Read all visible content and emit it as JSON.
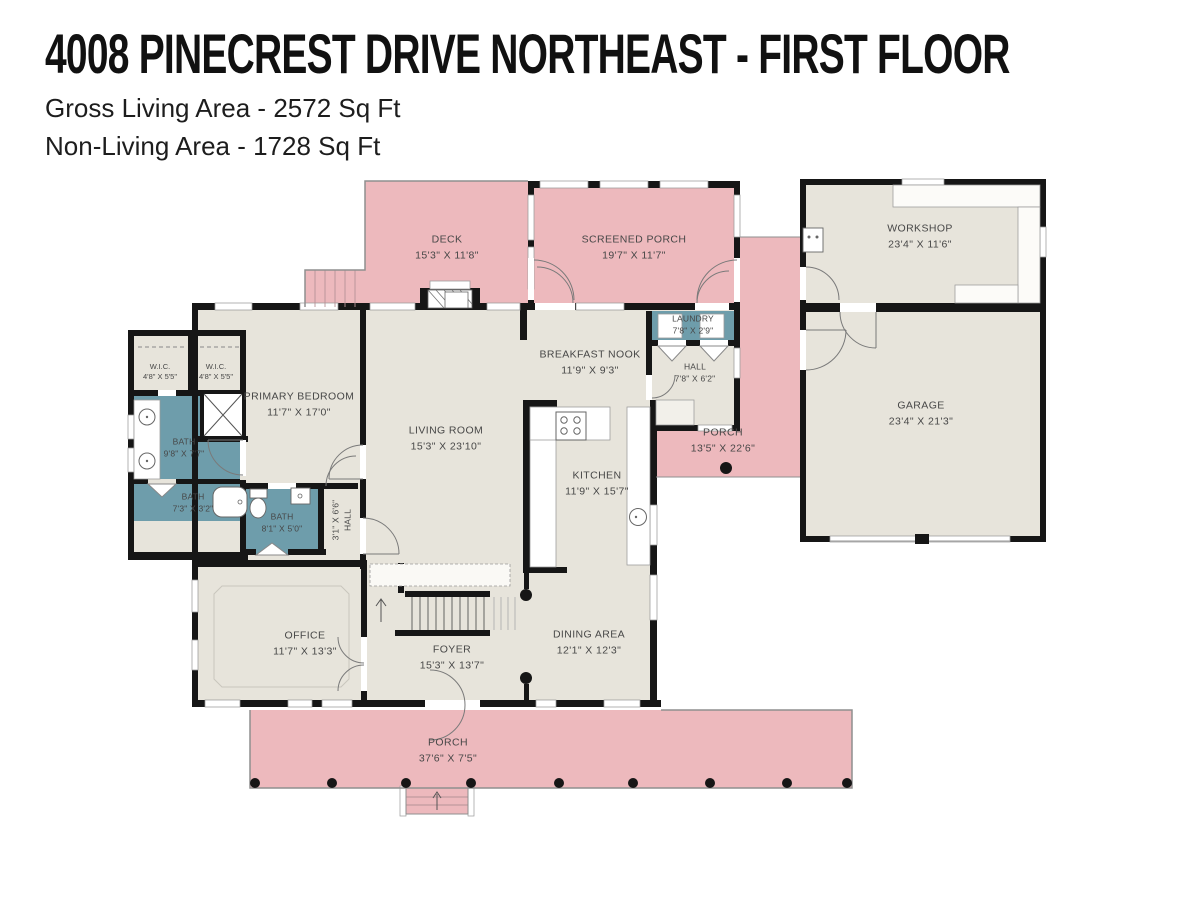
{
  "header": {
    "title": "4008 PINECREST DRIVE NORTHEAST - FIRST FLOOR",
    "gross_living": "Gross Living Area - 2572 Sq Ft",
    "non_living": "Non-Living Area - 1728 Sq Ft"
  },
  "palette": {
    "porch_pink": "#EDB9BD",
    "floor_beige": "#E7E4DB",
    "wet_room_teal": "#6E9DAB",
    "wall_black": "#161616",
    "fixture_white": "#FFFFFF",
    "label_gray": "#474747"
  },
  "rooms": [
    {
      "name": "DECK",
      "dims": "15'3\" X 11'8\""
    },
    {
      "name": "SCREENED PORCH",
      "dims": "19'7\" X 11'7\""
    },
    {
      "name": "WORKSHOP",
      "dims": "23'4\" X 11'6\""
    },
    {
      "name": "LAUNDRY",
      "dims": "7'8\" X 2'9\""
    },
    {
      "name": "BREAKFAST NOOK",
      "dims": "11'9\" X 9'3\""
    },
    {
      "name": "HALL",
      "dims": "7'8\" X 6'2\""
    },
    {
      "name": "GARAGE",
      "dims": "23'4\" X 21'3\""
    },
    {
      "name": "PORCH",
      "dims": "13'5\" X 22'6\""
    },
    {
      "name": "PRIMARY BEDROOM",
      "dims": "11'7\" X 17'0\""
    },
    {
      "name": "LIVING ROOM",
      "dims": "15'3\" X 23'10\""
    },
    {
      "name": "KITCHEN",
      "dims": "11'9\" X 15'7\""
    },
    {
      "name": "W.I.C.",
      "dims": "4'8\" X 5'5\""
    },
    {
      "name": "W.I.C.",
      "dims": "4'8\" X 5'5\""
    },
    {
      "name": "BATH",
      "dims": "9'8\" X 7'7\""
    },
    {
      "name": "BATH",
      "dims": "7'3\" X 3'2\""
    },
    {
      "name": "BATH",
      "dims": "8'1\" X 5'0\""
    },
    {
      "name": "HALL",
      "dims": "3'1\" X 6'6\""
    },
    {
      "name": "OFFICE",
      "dims": "11'7\" X 13'3\""
    },
    {
      "name": "FOYER",
      "dims": "15'3\" X 13'7\""
    },
    {
      "name": "DINING AREA",
      "dims": "12'1\" X 12'3\""
    },
    {
      "name": "PORCH",
      "dims": "37'6\" X 7'5\""
    }
  ]
}
